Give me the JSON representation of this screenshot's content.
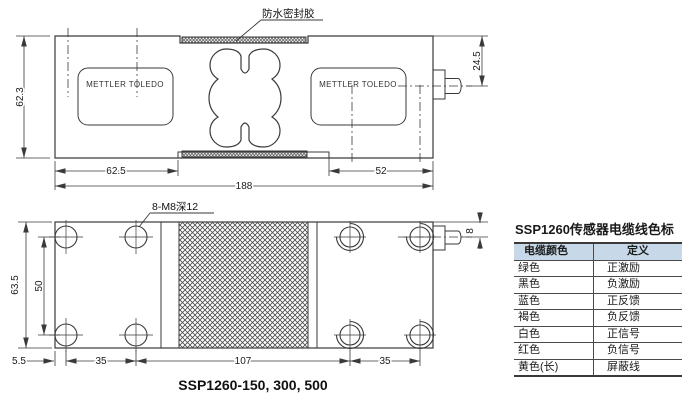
{
  "top_view": {
    "seal_label": "防水密封胶",
    "brand": "METTLER TOLEDO",
    "dim_height": "62.3",
    "dim_left": "62.5",
    "dim_total": "188",
    "dim_right": "52",
    "dim_cable_offset": "24.5"
  },
  "bottom_view": {
    "holes_label": "8-M8深12",
    "dim_height": "63.5",
    "dim_hole_span": "50",
    "dim_edge": "5.5",
    "dim_left_pitch": "35",
    "dim_center": "107",
    "dim_right_pitch": "35",
    "dim_cable_offset": "8",
    "caption": "SSP1260-150, 300, 500"
  },
  "cable_table": {
    "title": "SSP1260传感器电缆线色标",
    "headers": {
      "color": "电缆颜色",
      "definition": "定义"
    },
    "rows": [
      {
        "color": "绿色",
        "def": "正激励"
      },
      {
        "color": "黑色",
        "def": "负激励"
      },
      {
        "color": "蓝色",
        "def": "正反馈"
      },
      {
        "color": "褐色",
        "def": "负反馈"
      },
      {
        "color": "白色",
        "def": "正信号"
      },
      {
        "color": "红色",
        "def": "负信号"
      },
      {
        "color": "黄色(长)",
        "def": "屏蔽线"
      }
    ],
    "header_bg": "#c7d9e8"
  },
  "colors": {
    "line": "#3a3a3a",
    "text": "#1a1a1a"
  }
}
